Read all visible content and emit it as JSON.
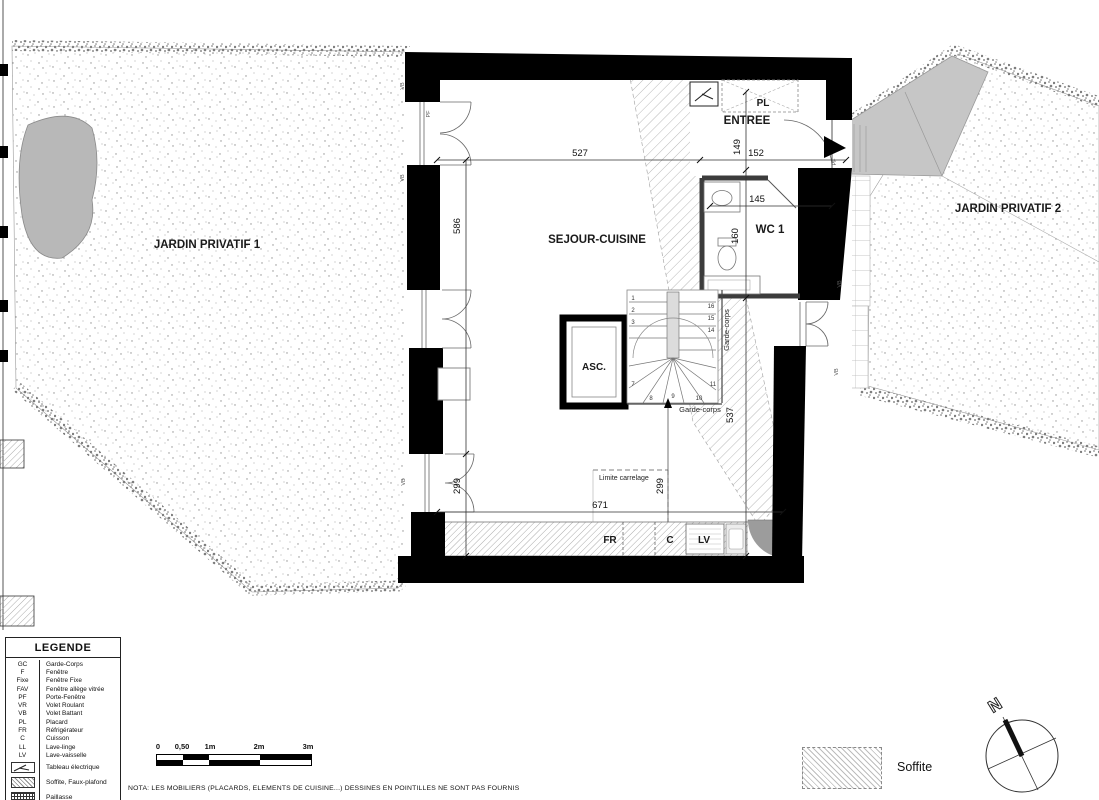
{
  "plan": {
    "rooms": {
      "jardin1": "JARDIN PRIVATIF 1",
      "jardin2": "JARDIN PRIVATIF 2",
      "sejour": "SEJOUR-CUISINE",
      "entree": "ENTREE",
      "wc": "WC 1",
      "asc": "ASC.",
      "pl": "PL"
    },
    "dimensions": {
      "d527": "527",
      "d586": "586",
      "d149": "149",
      "d152": "152",
      "d145": "145",
      "d160": "160",
      "d537": "537",
      "d299a": "299",
      "d299b": "299",
      "d671": "671"
    },
    "annotations": {
      "garde_corps_v": "Garde-corps",
      "garde_corps_h": "Garde-corps",
      "limite_carrelage": "Limite carrelage",
      "fr": "FR",
      "c": "C",
      "lv": "LV",
      "vb": "VB",
      "pf": "PF"
    },
    "stairs": {
      "numbers": [
        "1",
        "2",
        "3",
        "7",
        "8",
        "9",
        "10",
        "11",
        "14",
        "15",
        "16"
      ]
    }
  },
  "legend": {
    "title": "LEGENDE",
    "entries": [
      {
        "abbr": "GC",
        "label": "Garde-Corps"
      },
      {
        "abbr": "F",
        "label": "Fenêtre"
      },
      {
        "abbr": "Fixe",
        "label": "Fenêtre Fixe"
      },
      {
        "abbr": "FAV",
        "label": "Fenêtre allège vitrée"
      },
      {
        "abbr": "PF",
        "label": "Porte-Fenêtre"
      },
      {
        "abbr": "VR",
        "label": "Volet Roulant"
      },
      {
        "abbr": "VB",
        "label": "Volet Battant"
      },
      {
        "abbr": "PL",
        "label": "Placard"
      },
      {
        "abbr": "FR",
        "label": "Réfrigérateur"
      },
      {
        "abbr": "C",
        "label": "Cuisson"
      },
      {
        "abbr": "LL",
        "label": "Lave-linge"
      },
      {
        "abbr": "LV",
        "label": "Lave-vaisselle"
      }
    ],
    "icon_entries": [
      {
        "icon": "tableau-electrique-icon",
        "label": "Tableau électrique"
      },
      {
        "icon": "soffite-hatch-icon",
        "label": "Soffite, Faux-plafond"
      },
      {
        "icon": "paillasse-hatch-icon",
        "label": "Paillasse"
      }
    ]
  },
  "scale_bar": {
    "labels": [
      "0",
      "0,50",
      "1m",
      "2m",
      "3m"
    ]
  },
  "nota": "NOTA: LES MOBILIERS (PLACARDS, ELEMENTS DE CUISINE...) DESSINES EN POINTILLES NE SONT PAS FOURNIS",
  "soffite_key": {
    "label": "Soffite"
  },
  "compass": {
    "north": "N"
  },
  "colors": {
    "wall": "#000000",
    "hatch": "#b8b8b8",
    "stipple": "#8f8f8f",
    "walkway": "#c6c6c6",
    "text": "#111111"
  }
}
